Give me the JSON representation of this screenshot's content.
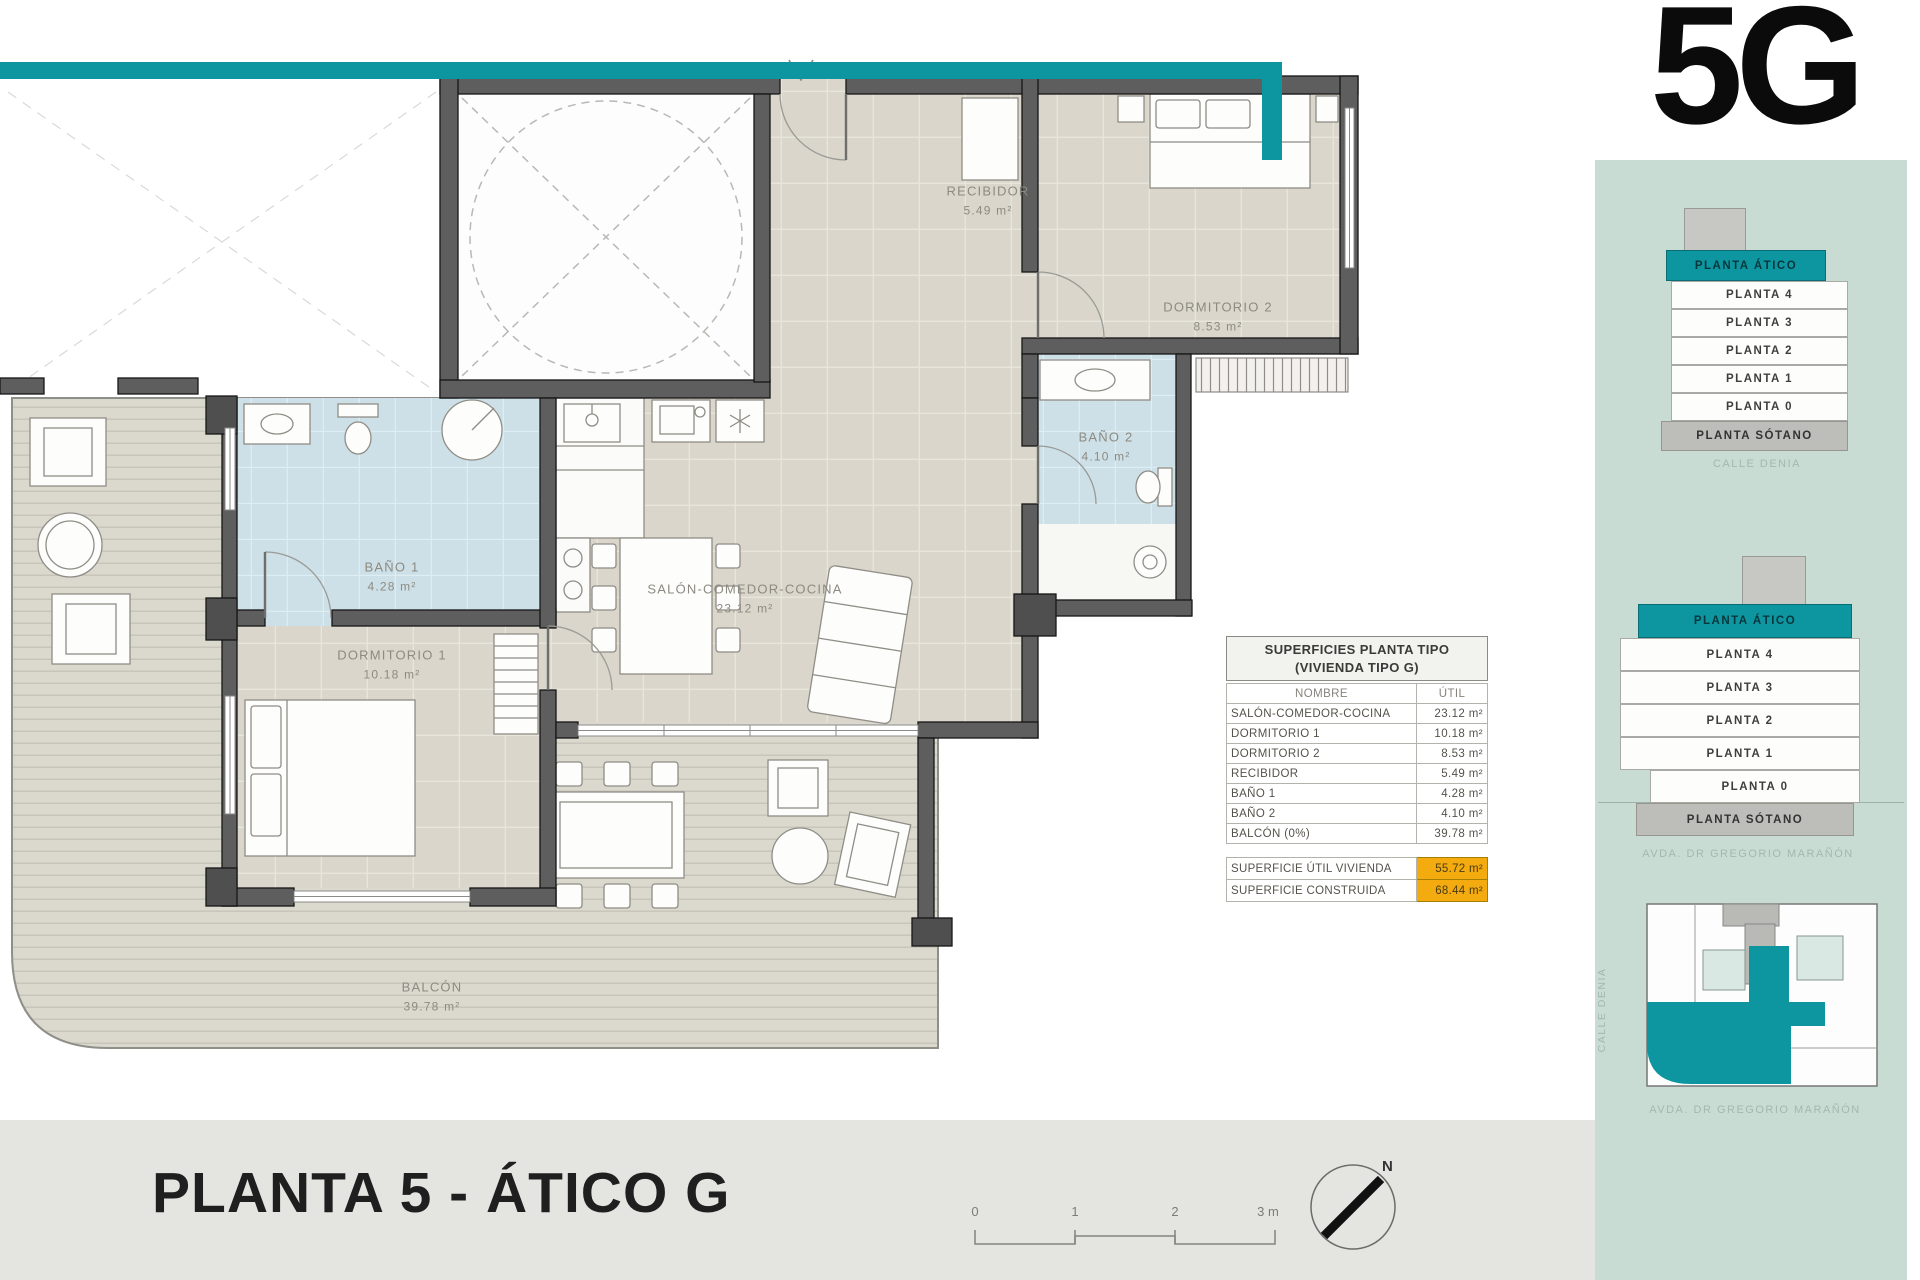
{
  "unit_code": "5G",
  "sheet_title": "PLANTA 5 - ÁTICO G",
  "north_label": "N",
  "scalebar": {
    "labels": [
      "0",
      "1",
      "2",
      "3 m"
    ]
  },
  "colors": {
    "teal": "#0e96a0",
    "panel_bg": "#c8dcd3",
    "highlight_yellow": "#f3ab10",
    "wall_gray": "#5e5e5e"
  },
  "rooms": {
    "recibidor": {
      "name": "RECIBIDOR",
      "area": "5.49 m²"
    },
    "dormitorio2": {
      "name": "DORMITORIO 2",
      "area": "8.53 m²"
    },
    "bano2": {
      "name": "BAÑO 2",
      "area": "4.10 m²"
    },
    "bano1": {
      "name": "BAÑO 1",
      "area": "4.28 m²"
    },
    "dormitorio1": {
      "name": "DORMITORIO 1",
      "area": "10.18 m²"
    },
    "salon": {
      "name": "SALÓN-COMEDOR-COCINA",
      "area": "23.12 m²"
    },
    "balcon": {
      "name": "BALCÓN",
      "area": "39.78 m²"
    }
  },
  "areas_table": {
    "title_line1": "SUPERFICIES PLANTA TIPO",
    "title_line2": "(VIVIENDA TIPO G)",
    "col_name": "NOMBRE",
    "col_util": "ÚTIL",
    "rows": [
      {
        "name": "SALÓN-COMEDOR-COCINA",
        "util": "23.12 m²"
      },
      {
        "name": "DORMITORIO 1",
        "util": "10.18 m²"
      },
      {
        "name": "DORMITORIO 2",
        "util": "8.53 m²"
      },
      {
        "name": "RECIBIDOR",
        "util": "5.49 m²"
      },
      {
        "name": "BAÑO 1",
        "util": "4.28 m²"
      },
      {
        "name": "BAÑO 2",
        "util": "4.10 m²"
      },
      {
        "name": "BALCÓN (0%)",
        "util": "39.78 m²"
      }
    ],
    "summary": [
      {
        "name": "SUPERFICIE ÚTIL VIVIENDA",
        "value": "55.72 m²"
      },
      {
        "name": "SUPERFICIE CONSTRUIDA",
        "value": "68.44 m²"
      }
    ]
  },
  "side_panel": {
    "stack1": {
      "floors": [
        "PLANTA ÁTICO",
        "PLANTA 4",
        "PLANTA 3",
        "PLANTA 2",
        "PLANTA 1",
        "PLANTA 0",
        "PLANTA SÓTANO"
      ],
      "street": "CALLE DENIA"
    },
    "stack2": {
      "floors": [
        "PLANTA ÁTICO",
        "PLANTA 4",
        "PLANTA 3",
        "PLANTA 2",
        "PLANTA 1",
        "PLANTA 0",
        "PLANTA SÓTANO"
      ],
      "street": "AVDA. DR GREGORIO MARAÑÓN"
    },
    "siteplan": {
      "street_left": "CALLE DENIA",
      "street_bottom": "AVDA. DR GREGORIO MARAÑÓN"
    }
  }
}
